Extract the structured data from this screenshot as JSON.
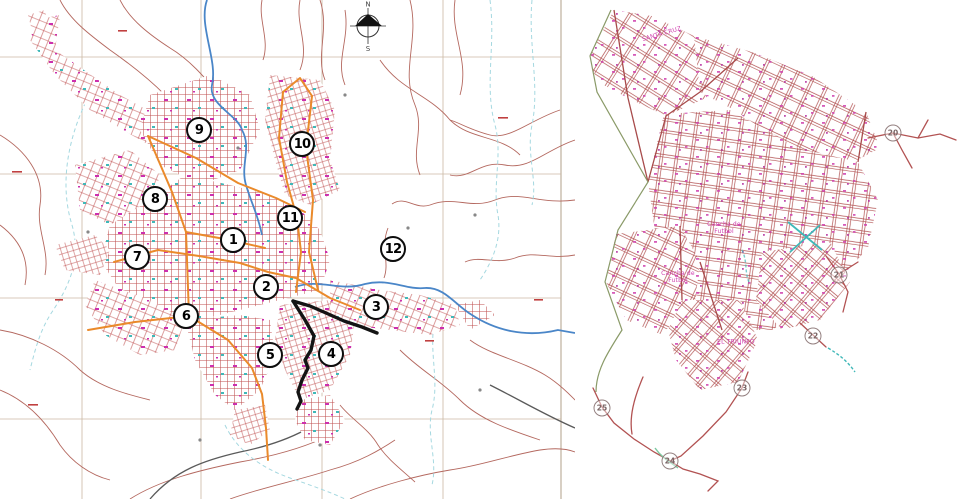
{
  "canvas": {
    "width": 960,
    "height": 499,
    "background": "#ffffff"
  },
  "left_map": {
    "title": "city-zoning-map",
    "compass": {
      "north_label": "N",
      "south_label": "S"
    },
    "colors": {
      "contour": "#b4685f",
      "urban_grid": "#c05050",
      "orange_road": "#ea8a2b",
      "river": "#4a86c8",
      "stream": "#a5d8e0",
      "grid_line": "#cbb8a4",
      "boundary": "#141414",
      "railroad": "#5a5a5a",
      "marker_ring": "#0d0d0d",
      "speckle_magenta": "#cc2fae",
      "speckle_teal": "#3fb8b8"
    },
    "zone_markers": [
      {
        "label": "1",
        "x": 233,
        "y": 240
      },
      {
        "label": "2",
        "x": 266,
        "y": 287
      },
      {
        "label": "3",
        "x": 376,
        "y": 307
      },
      {
        "label": "4",
        "x": 331,
        "y": 354
      },
      {
        "label": "5",
        "x": 270,
        "y": 355
      },
      {
        "label": "6",
        "x": 186,
        "y": 316
      },
      {
        "label": "7",
        "x": 137,
        "y": 257
      },
      {
        "label": "8",
        "x": 155,
        "y": 199
      },
      {
        "label": "9",
        "x": 199,
        "y": 130
      },
      {
        "label": "10",
        "x": 302,
        "y": 144
      },
      {
        "label": "11",
        "x": 290,
        "y": 218
      },
      {
        "label": "12",
        "x": 393,
        "y": 249
      }
    ]
  },
  "right_map": {
    "title": "district-street-plan",
    "colors": {
      "street": "#b25252",
      "label": "#cf3fae",
      "edge_green": "#8a9a68",
      "teal": "#3fb8b8"
    },
    "route_markers": [
      {
        "label": "20",
        "x": 893,
        "y": 133
      },
      {
        "label": "21",
        "x": 839,
        "y": 275
      },
      {
        "label": "22",
        "x": 813,
        "y": 336
      },
      {
        "label": "23",
        "x": 742,
        "y": 388
      },
      {
        "label": "24",
        "x": 670,
        "y": 461
      },
      {
        "label": "25",
        "x": 602,
        "y": 408
      }
    ],
    "labels": [
      {
        "text": "SANTA CRUZ",
        "x": 662,
        "y": 35,
        "rot": -16
      },
      {
        "text": "Cancha de\nFutbol",
        "x": 724,
        "y": 229,
        "rot": 0
      },
      {
        "text": "Cancha de\nFutbol",
        "x": 678,
        "y": 278,
        "rot": 0
      },
      {
        "text": "EL TRIUNFO",
        "x": 736,
        "y": 343,
        "rot": 0
      }
    ]
  }
}
